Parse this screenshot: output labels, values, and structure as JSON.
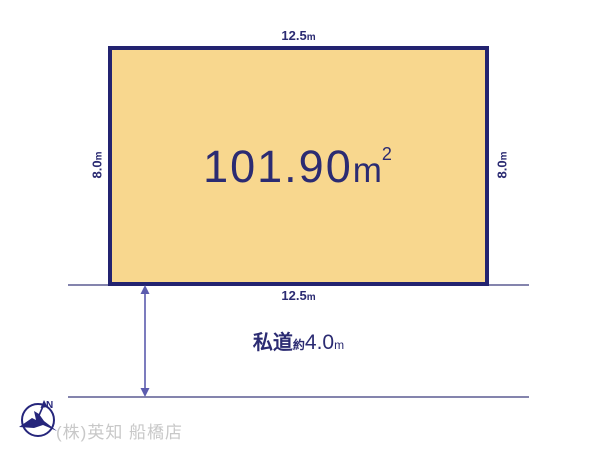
{
  "colors": {
    "plot_fill": "#f8d78e",
    "plot_border": "#232370",
    "text_navy": "#2b2b72",
    "road_line": "#8484ad",
    "arrow": "#5c5cae",
    "compass": "#26267c",
    "footer_text": "#c8c8c8"
  },
  "plot": {
    "area": {
      "value": "101.90",
      "unit": "m",
      "sup": "2"
    },
    "dim_top": {
      "value": "12.5",
      "unit": "m"
    },
    "dim_bottom": {
      "value": "12.5",
      "unit": "m"
    },
    "dim_left": {
      "value": "8.0",
      "unit": "m"
    },
    "dim_right": {
      "value": "8.0",
      "unit": "m"
    }
  },
  "road": {
    "name": "私道",
    "approx": "約",
    "width_value": "4.0",
    "width_unit": "m"
  },
  "footer": {
    "company": "(株)英知 船橋店",
    "compass_n": "N"
  }
}
